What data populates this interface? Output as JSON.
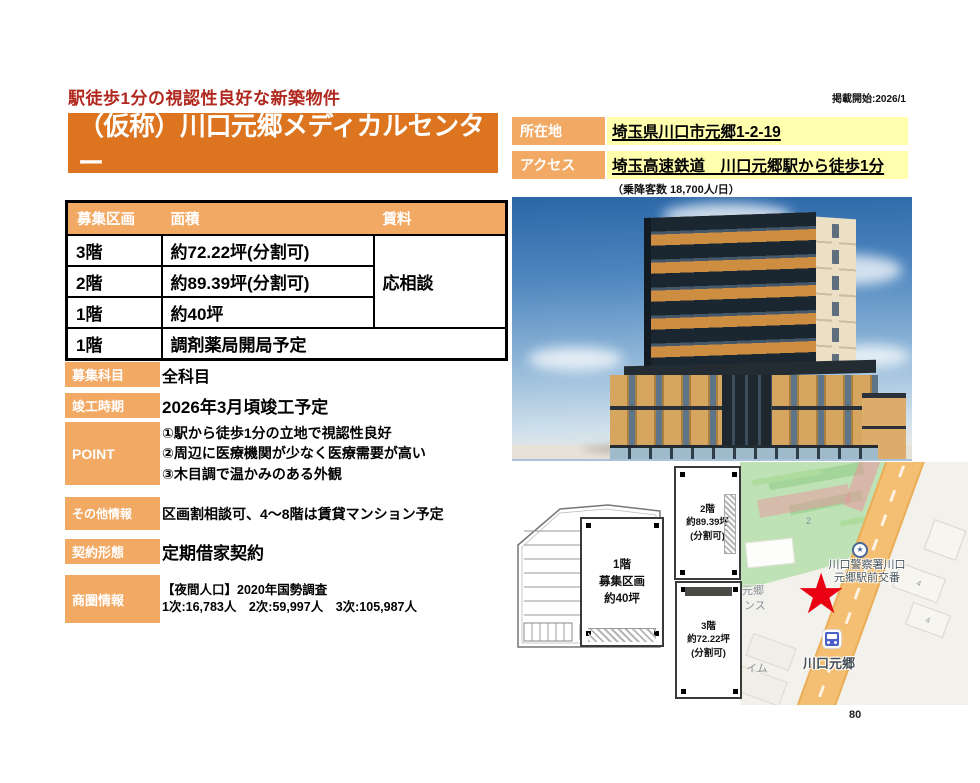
{
  "header": {
    "catch_copy": "駅徒歩1分の視認性良好な新築物件",
    "publish_start": "掲載開始:2026/1",
    "building_name": "（仮称）川口元郷メディカルセンター"
  },
  "location_row": {
    "label": "所在地",
    "value": "埼玉県川口市元郷1-2-19"
  },
  "access_row": {
    "label": "アクセス",
    "value": "埼玉高速鉄道　川口元郷駅から徒歩1分",
    "note": "（乗降客数 18,700人/日）"
  },
  "table": {
    "headers": [
      "募集区画",
      "面積",
      "賃料"
    ],
    "rows": [
      {
        "floor": "3階",
        "area": "約72.22坪(分割可)"
      },
      {
        "floor": "2階",
        "area": "約89.39坪(分割可)"
      },
      {
        "floor": "1階",
        "area": "約40坪"
      },
      {
        "floor": "1階",
        "area": "調剤薬局開局予定"
      }
    ],
    "rent_note": "応相談"
  },
  "details": [
    {
      "label": "募集科目",
      "value": "全科目"
    },
    {
      "label": "竣工時期",
      "value": "2026年3月頃竣工予定"
    },
    {
      "label": "POINT",
      "lines": [
        "①駅から徒歩1分の立地で視認性良好",
        "②周辺に医療機関が少なく医療需要が高い",
        "③木目調で温かみのある外観"
      ]
    },
    {
      "label": "その他情報",
      "value": "区画割相談可、4～8階は賃貸マンション予定"
    },
    {
      "label": "契約形態",
      "value": "定期借家契約"
    },
    {
      "label": "商圏情報",
      "lines": [
        "【夜間人口】2020年国勢調査",
        "1次:16,783人　2次:59,997人　3次:105,987人"
      ]
    }
  ],
  "floor_plans": {
    "f1": [
      "1階",
      "募集区画",
      "約40坪"
    ],
    "f2": [
      "2階",
      "約89.39坪",
      "(分割可)"
    ],
    "f3": [
      "3階",
      "約72.22坪",
      "(分割可)"
    ]
  },
  "map": {
    "police_label_line1": "川口警察署川口",
    "police_label_line2": "元郷駅前交番",
    "station_label": "川口元郷",
    "road_number": "2",
    "block_number": "4",
    "partial_label_1": "元郷",
    "partial_label_2": "ンス",
    "partial_label_3": "イム",
    "star_glyph": "★",
    "police_star_glyph": "★"
  },
  "footer": {
    "page_number": "80"
  },
  "colors": {
    "banner_orange": "#DC7420",
    "panel_orange": "#F2A964",
    "highlight_yellow": "#FFFFAD",
    "catch_red": "#B0281E",
    "star_red": "#EA0013"
  }
}
